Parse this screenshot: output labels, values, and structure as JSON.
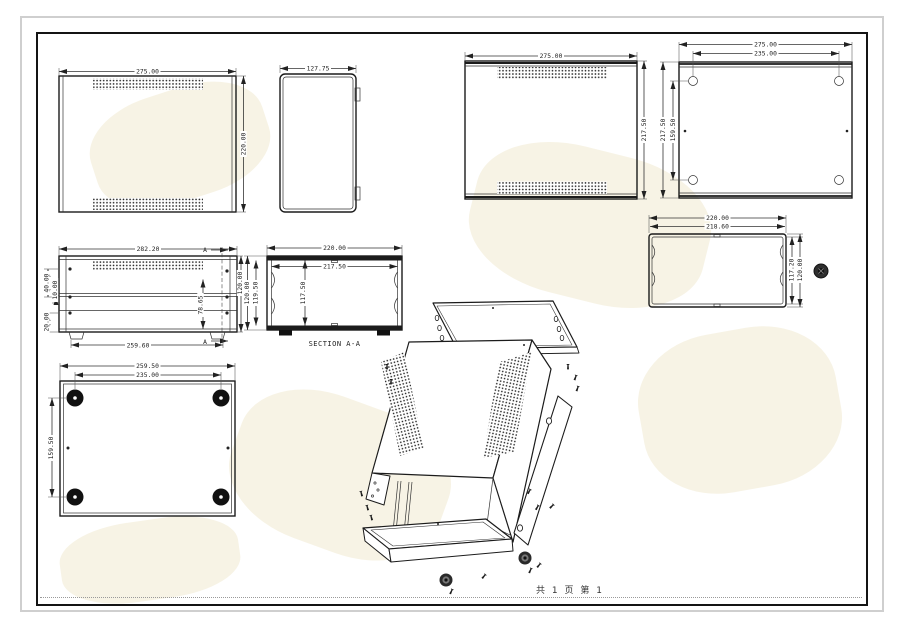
{
  "views": {
    "top_view": {
      "width": "275.00",
      "height": "220.00"
    },
    "side_view": {
      "width": "127.75"
    },
    "inner_top_view": {
      "width": "275.00",
      "height": "217.50"
    },
    "base_view": {
      "width": "275.00",
      "hole_width": "235.00",
      "height": "217.50",
      "hole_height": "159.50"
    },
    "front_view": {
      "top_width": "282.20",
      "bottom_width": "259.60",
      "height": "120.00",
      "d40": "40.00",
      "d10": "10.00",
      "d20": "20.00",
      "d78": "78.65",
      "section_mark": "A"
    },
    "section_view": {
      "label": "SECTION A-A",
      "width": "220.00",
      "inner_width": "217.50",
      "inner_height": "117.50",
      "outer_height": "120.00",
      "inner_height2": "119.50"
    },
    "rear_view": {
      "width": "220.00",
      "inner_width": "218.60",
      "inner_height": "117.20",
      "height": "120.00"
    },
    "bottom_view": {
      "width": "259.50",
      "feet_width": "235.00",
      "feet_height": "159.50"
    }
  },
  "footer": {
    "page_info": "共 1 页  第 1"
  }
}
